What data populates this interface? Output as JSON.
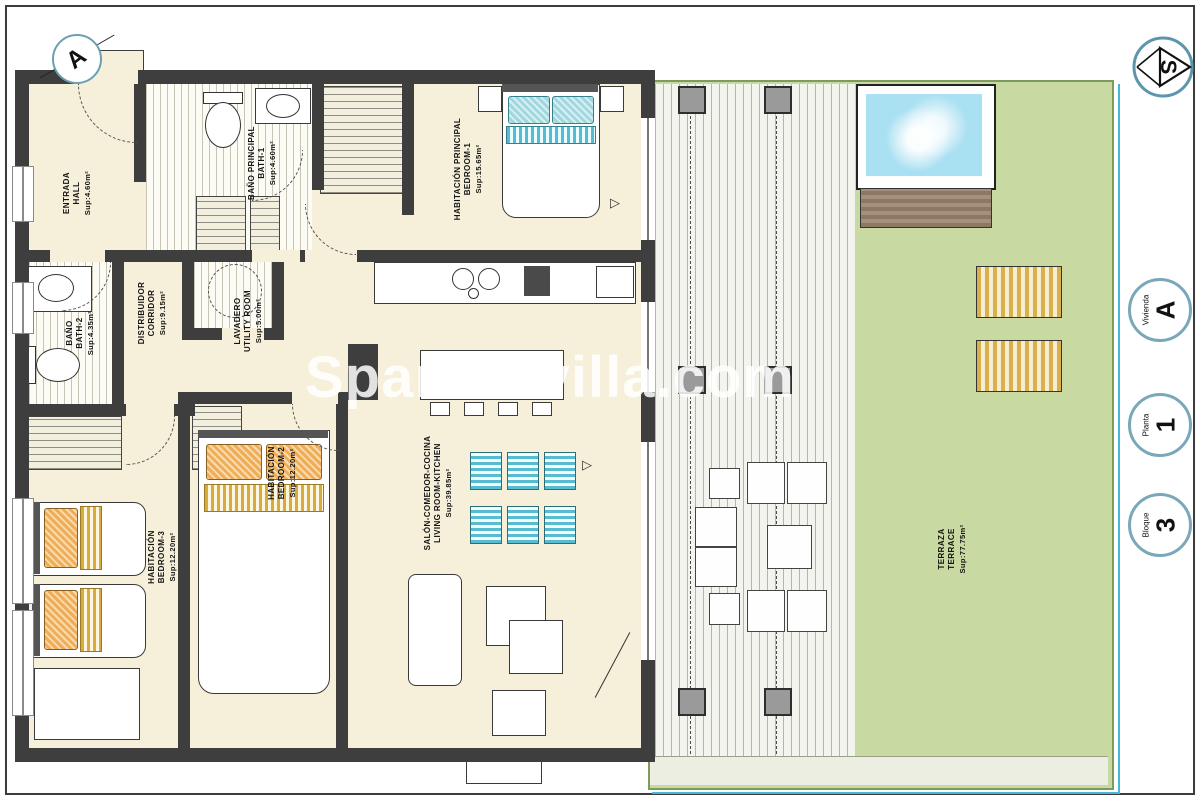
{
  "watermark": {
    "text": "Spanishvilla.com"
  },
  "markers": {
    "section_letter": "A",
    "compass_letter": "S"
  },
  "rooms": {
    "hall": {
      "name_es": "ENTRADA",
      "name_en": "HALL",
      "area": "Sup:4.60m²"
    },
    "bath1": {
      "name_es": "BAÑO PRINCIPAL",
      "name_en": "BATH-1",
      "area": "Sup:4.60m²"
    },
    "bedroom1": {
      "name_es": "HABITACIÓN PRINCIPAL",
      "name_en": "BEDROOM-1",
      "area": "Sup:15.65m²"
    },
    "corridor": {
      "name_es": "DISTRIBUIDOR",
      "name_en": "CORRIDOR",
      "area": "Sup:9.15m²"
    },
    "utility": {
      "name_es": "LAVADERO",
      "name_en": "UTILITY ROOM",
      "area": "Sup:5.00m²"
    },
    "bath2": {
      "name_es": "BAÑO",
      "name_en": "BATH-2",
      "area": "Sup:4.35m²"
    },
    "bedroom2": {
      "name_es": "HABITACIÓN",
      "name_en": "BEDROOM-2",
      "area": "Sup:12.20m²"
    },
    "bedroom3": {
      "name_es": "HABITACIÓN",
      "name_en": "BEDROOM-3",
      "area": "Sup:12.20m²"
    },
    "living": {
      "name_es": "SALÓN-COMEDOR-COCINA",
      "name_en": "LIVING ROOM-KITCHEN",
      "area": "Sup:39.85m²"
    },
    "terrace": {
      "name_es": "TERRAZA",
      "name_en": "TERRACE",
      "area": "Sup:77.75m²"
    }
  },
  "badges": [
    {
      "label": "Vivienda",
      "value": "A"
    },
    {
      "label": "Planta",
      "value": "1"
    },
    {
      "label": "Bloque",
      "value": "3"
    }
  ],
  "colors": {
    "wall": "#3e3e3e",
    "interior_floor": "#f6f0da",
    "terrace_green": "#c8d9a1",
    "pool_water": "#a9e0f2",
    "deck_wood_brown": "#8d7765",
    "accent_teal": "#45b8d8",
    "lounger_gold": "#d9b14c",
    "pillow_orange": "#efae55",
    "pillow_teal": "#9fd8de",
    "badge_ring": "#7aa7ba"
  }
}
